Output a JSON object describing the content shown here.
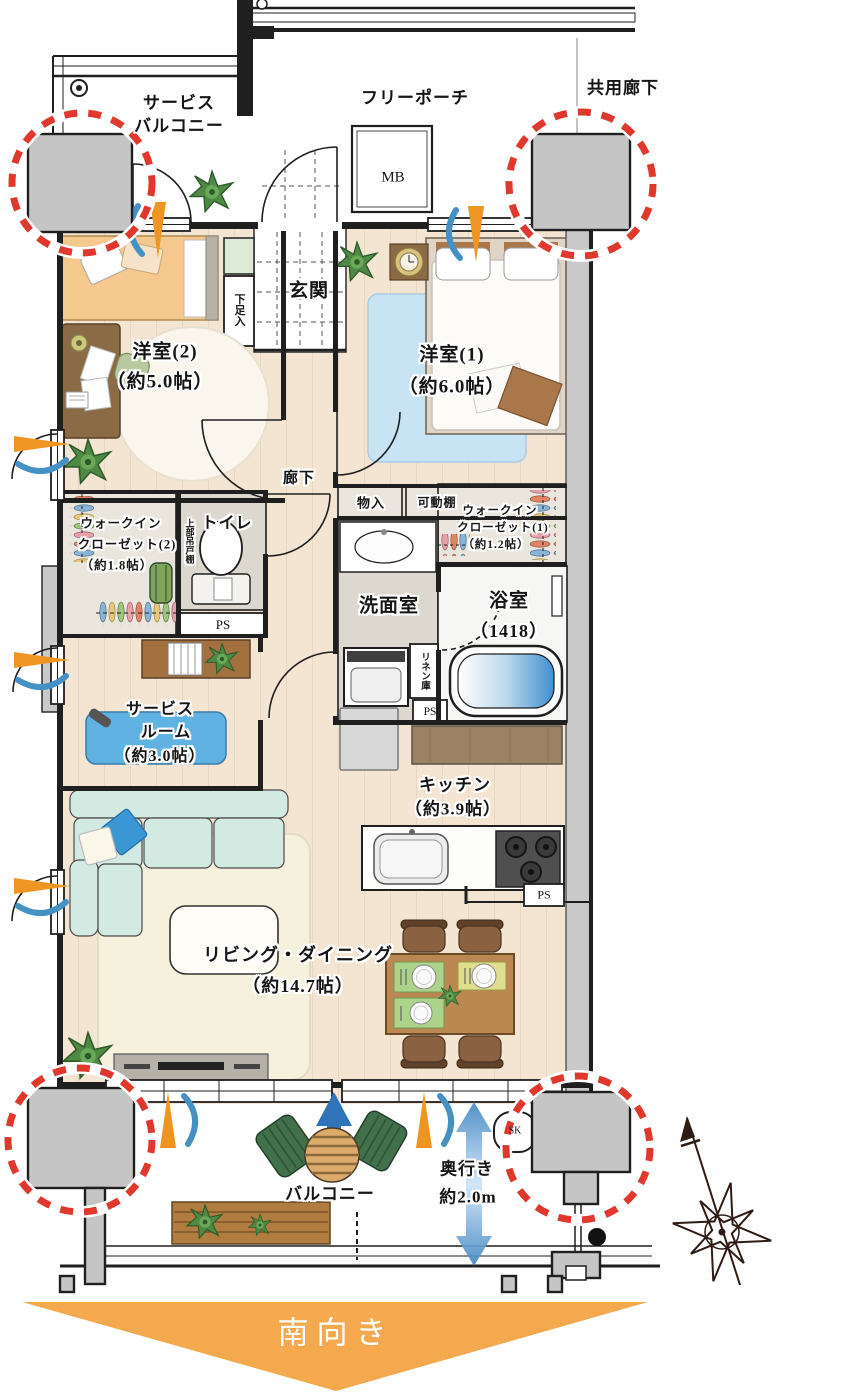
{
  "colors": {
    "accent_red": "#e0382c",
    "arrow_orange": "#ef9523",
    "arrow_blue": "#4591c6",
    "south_arrow_orange": "#f5a94e",
    "wall_gray": "#c5c5c5",
    "wood_floor": "#f3e5d1"
  },
  "exterior": {
    "service_balcony_line1": "サービス",
    "service_balcony_line2": "バルコニー",
    "free_porch": "フリーポーチ",
    "common_corridor": "共用廊下",
    "meter_box": "MB"
  },
  "rooms": {
    "entrance": "玄関",
    "shoe_cabinet": "下足入",
    "bedroom2_name": "洋室(2)",
    "bedroom2_size": "（約5.0帖）",
    "bedroom1_name": "洋室(1)",
    "bedroom1_size": "（約6.0帖）",
    "corridor": "廊下",
    "storage": "物入",
    "movable_shelf": "可動棚",
    "wic1_line1": "ウォークイン",
    "wic1_line2": "クローゼット(1)",
    "wic1_line3": "（約1.2帖）",
    "wic2_line1": "ウォークイン",
    "wic2_line2": "クローゼット(2)",
    "wic2_line3": "（約1.8帖）",
    "toilet": "トイレ",
    "upper_cabinet": "上部吊戸棚",
    "washroom": "洗面室",
    "linen_cabinet": "リネン庫",
    "bathroom_name": "浴室",
    "bathroom_size": "（1418）",
    "service_room_line1": "サービス",
    "service_room_line2": "ルーム",
    "service_room_line3": "（約3.0帖）",
    "kitchen_name": "キッチン",
    "kitchen_size": "（約3.9帖）",
    "living_dining_name": "リビング・ダイニング",
    "living_dining_size": "（約14.7帖）",
    "ps": "PS",
    "sk": "SK"
  },
  "balcony": {
    "label": "バルコニー",
    "depth_line1": "奥行き",
    "depth_line2": "約2.0m"
  },
  "direction": {
    "south": "南向き"
  }
}
